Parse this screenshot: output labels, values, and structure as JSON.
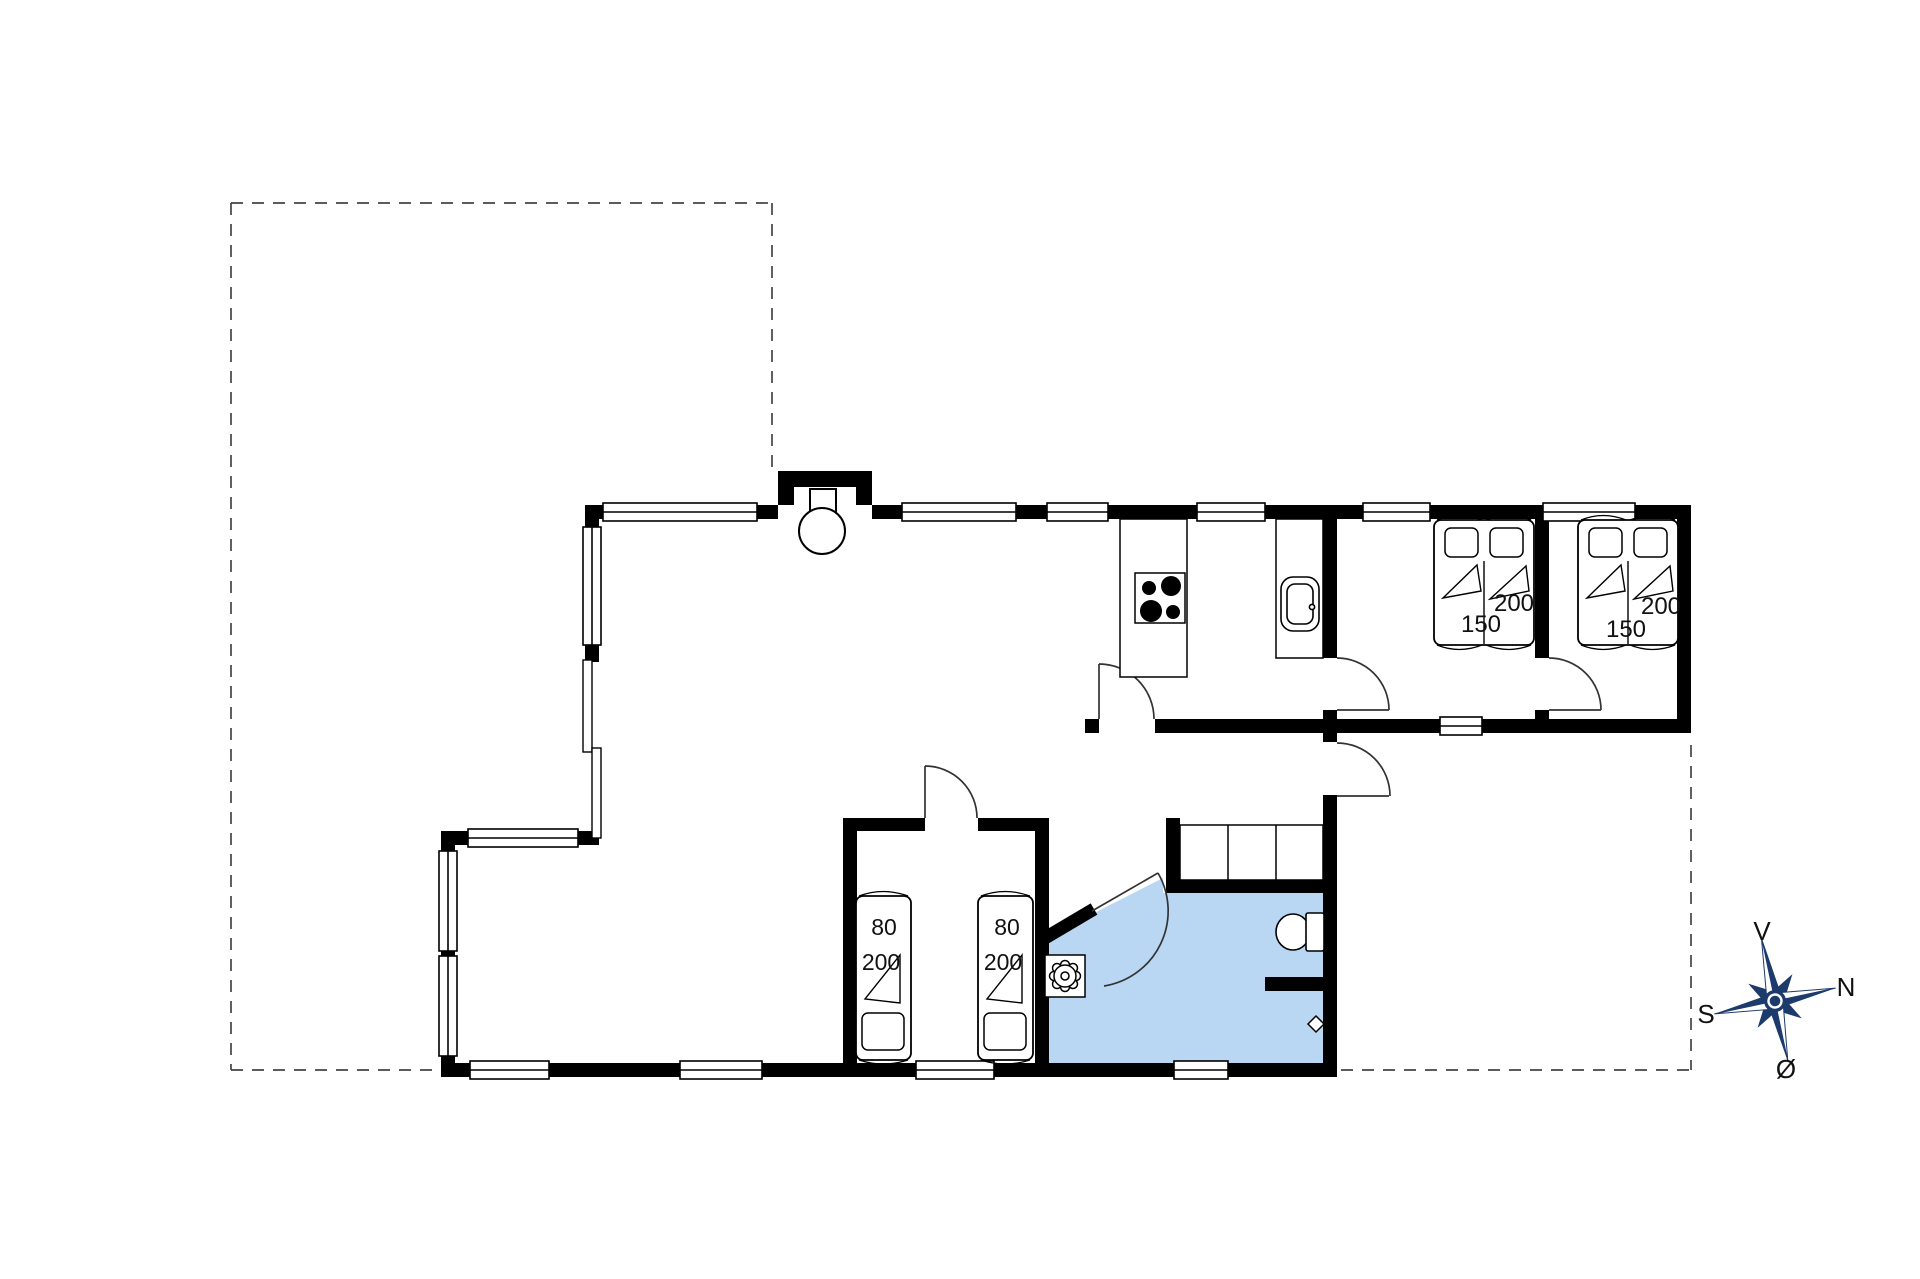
{
  "plan": {
    "background": "#ffffff",
    "wall_color": "#000000",
    "bathroom_fill": "#b9d7f3",
    "bed_labels": {
      "double_bed_1": {
        "width": "150",
        "length": "200"
      },
      "double_bed_2": {
        "width": "150",
        "length": "200"
      },
      "single_bed_1": {
        "width": "80",
        "length": "200"
      },
      "single_bed_2": {
        "width": "80",
        "length": "200"
      }
    },
    "compass": {
      "up": "V",
      "right": "N",
      "left": "S",
      "down": "Ø",
      "rose_color": "#1c3a6b",
      "label_color": "#1a1a1a"
    }
  }
}
